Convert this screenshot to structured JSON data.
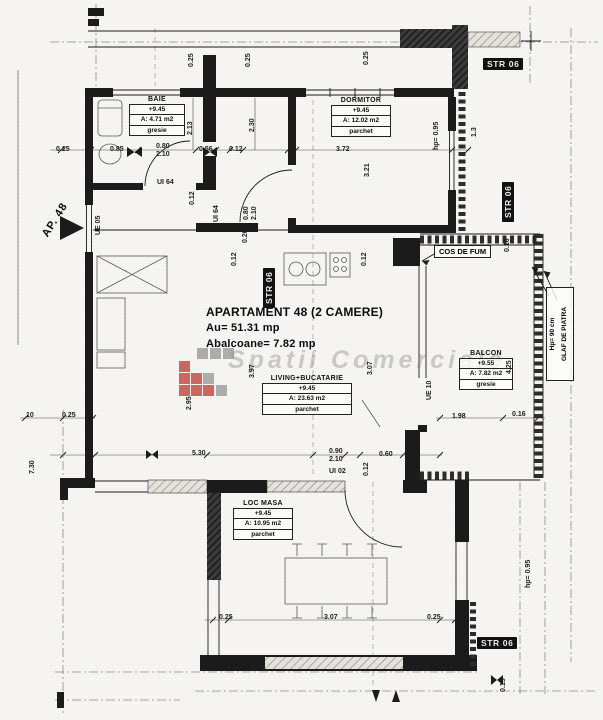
{
  "colors": {
    "paper": "#f6f5f1",
    "ink": "#1a1a1a",
    "red": "#c0443c",
    "gray": "#9a9a9a",
    "wm": "rgba(130,130,130,0.38)"
  },
  "title_block": {
    "line1": "APARTAMENT 48 (2 CAMERE)",
    "line2": "Au= 51.31 mp",
    "line3": "Abalcoane= 7.82 mp"
  },
  "rooms": [
    {
      "name": "BAIE",
      "level": "+9.45",
      "area": "A: 4.71 m2",
      "floor": "gresie"
    },
    {
      "name": "DORMITOR",
      "level": "+9.45",
      "area": "A: 12.02 m2",
      "floor": "parchet"
    },
    {
      "name": "LIVING+BUCATARIE",
      "level": "+9.45",
      "area": "A: 23.63 m2",
      "floor": "parchet"
    },
    {
      "name": "BALCON",
      "level": "+9.55",
      "area": "A: 7.82 m2",
      "floor": "gresie"
    },
    {
      "name": "LOC MASA",
      "level": "+9.45",
      "area": "A: 10.95 m2",
      "floor": "parchet"
    }
  ],
  "labels": {
    "cos_de_fum": "COS DE FUM",
    "glaf_line1": "Hp= 90 cm",
    "glaf_line2": "GLAF DE PIATRA",
    "ap_number": "AP. 48",
    "watermark": "Spatii Comerciale"
  },
  "str_labels": [
    {
      "t": "STR 06",
      "x": 483,
      "y": 58
    },
    {
      "t": "STR 06",
      "x": 502,
      "y": 222,
      "r": 1
    },
    {
      "t": "STR 06",
      "x": 263,
      "y": 308,
      "r": 1
    },
    {
      "t": "STR 06",
      "x": 477,
      "y": 637
    }
  ],
  "annotations": [
    {
      "t": "0.25",
      "x": 56,
      "y": 146
    },
    {
      "t": "0.85",
      "x": 110,
      "y": 146
    },
    {
      "t": "0.80\n2.10",
      "x": 156,
      "y": 143
    },
    {
      "t": "0.56",
      "x": 199,
      "y": 146
    },
    {
      "t": "0.12",
      "x": 229,
      "y": 146
    },
    {
      "t": "3.72",
      "x": 336,
      "y": 146
    },
    {
      "t": "3.21",
      "x": 364,
      "y": 177,
      "r": 1
    },
    {
      "t": "2.13",
      "x": 187,
      "y": 135,
      "r": 1
    },
    {
      "t": "2.30",
      "x": 249,
      "y": 132,
      "r": 1
    },
    {
      "t": "hp= 0.95",
      "x": 433,
      "y": 150,
      "r": 1
    },
    {
      "t": "1.3",
      "x": 471,
      "y": 137,
      "r": 1
    },
    {
      "t": "0.25",
      "x": 188,
      "y": 67,
      "r": 1
    },
    {
      "t": "0.25",
      "x": 245,
      "y": 67,
      "r": 1
    },
    {
      "t": "0.25",
      "x": 363,
      "y": 65,
      "r": 1
    },
    {
      "t": "UI 64",
      "x": 157,
      "y": 179,
      "n": "door-code-label"
    },
    {
      "t": "0.12",
      "x": 189,
      "y": 205,
      "r": 1
    },
    {
      "t": "UI 64",
      "x": 213,
      "y": 222,
      "r": 1,
      "n": "door-code-label"
    },
    {
      "t": "UE 05",
      "x": 95,
      "y": 235,
      "r": 1,
      "n": "door-code-label"
    },
    {
      "t": "0.80\n2.10",
      "x": 243,
      "y": 220,
      "r": 1
    },
    {
      "t": "0.20",
      "x": 242,
      "y": 243,
      "r": 1
    },
    {
      "t": "0.12",
      "x": 231,
      "y": 266,
      "r": 1
    },
    {
      "t": "0.16",
      "x": 504,
      "y": 252,
      "r": 1
    },
    {
      "t": "0.12",
      "x": 361,
      "y": 266,
      "r": 1
    },
    {
      "t": "4.25",
      "x": 506,
      "y": 374,
      "r": 1
    },
    {
      "t": "UE 10",
      "x": 426,
      "y": 400,
      "r": 1,
      "n": "door-code-label"
    },
    {
      "t": "1.98",
      "x": 452,
      "y": 413
    },
    {
      "t": "0.16",
      "x": 512,
      "y": 411
    },
    {
      "t": "3.97",
      "x": 249,
      "y": 378,
      "r": 1
    },
    {
      "t": "3.07",
      "x": 367,
      "y": 375,
      "r": 1
    },
    {
      "t": "2.95",
      "x": 186,
      "y": 410,
      "r": 1
    },
    {
      "t": "5.30",
      "x": 192,
      "y": 450
    },
    {
      "t": "0.90\n2.10",
      "x": 329,
      "y": 448
    },
    {
      "t": "0.12",
      "x": 363,
      "y": 476,
      "r": 1
    },
    {
      "t": "0.60",
      "x": 379,
      "y": 451
    },
    {
      "t": "UI 02",
      "x": 329,
      "y": 468,
      "n": "door-code-label"
    },
    {
      "t": "10",
      "x": 26,
      "y": 412
    },
    {
      "t": "0.25",
      "x": 62,
      "y": 412
    },
    {
      "t": "7.30",
      "x": 29,
      "y": 474,
      "r": 1
    },
    {
      "t": "0.25",
      "x": 219,
      "y": 614
    },
    {
      "t": "3.07",
      "x": 324,
      "y": 614
    },
    {
      "t": "0.25",
      "x": 427,
      "y": 614
    },
    {
      "t": "0.15",
      "x": 500,
      "y": 692,
      "r": 1
    },
    {
      "t": "hp= 0.95",
      "x": 525,
      "y": 588,
      "r": 1
    }
  ]
}
